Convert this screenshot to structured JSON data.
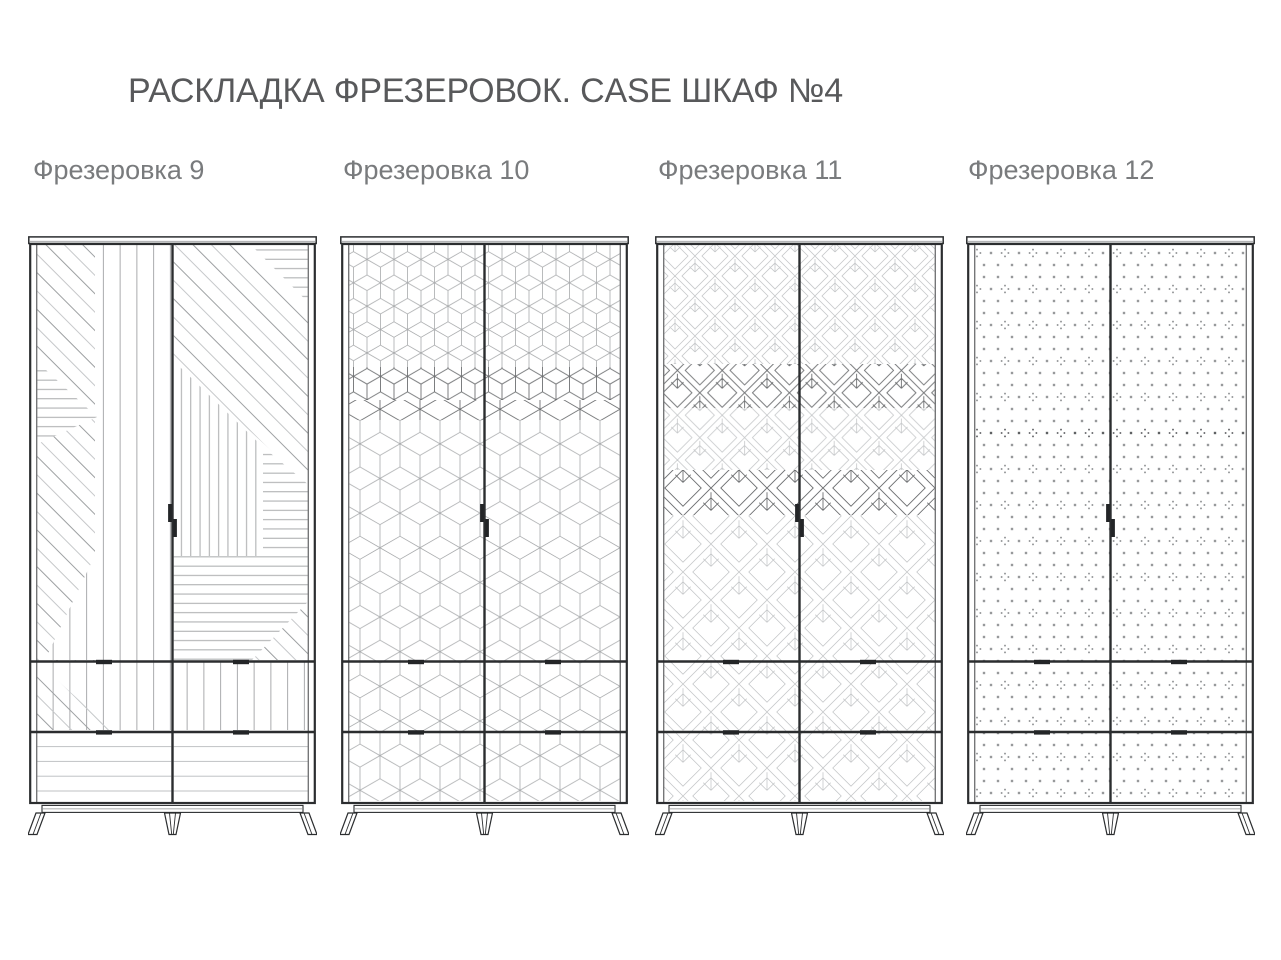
{
  "header": {
    "title": "РАСКЛАДКА ФРЕЗЕРОВОК. CASE ШКАФ №4"
  },
  "variants": [
    {
      "label": "Фрезеровка 9",
      "pattern": "geometric-stripes"
    },
    {
      "label": "Фрезеровка 10",
      "pattern": "tumbling-cubes"
    },
    {
      "label": "Фрезеровка 11",
      "pattern": "diamond-chevrons"
    },
    {
      "label": "Фрезеровка 12",
      "pattern": "dot-grid"
    }
  ],
  "colors": {
    "background": "#ffffff",
    "frame": "#2b2d2f",
    "handle": "#232527",
    "pattern_light": "#c6c8ca",
    "pattern_mid": "#9da0a2",
    "pattern_gray": "#a8aaac",
    "pattern_soft": "#bfc1c3",
    "pattern_dark": "#6e7072",
    "dots": "#97999b",
    "dots_accent": "#86888a",
    "dots_dark": "#5f6163",
    "dots_dark_accent": "#55575a",
    "title_text": "#58595b",
    "label_text": "#797b7d"
  }
}
